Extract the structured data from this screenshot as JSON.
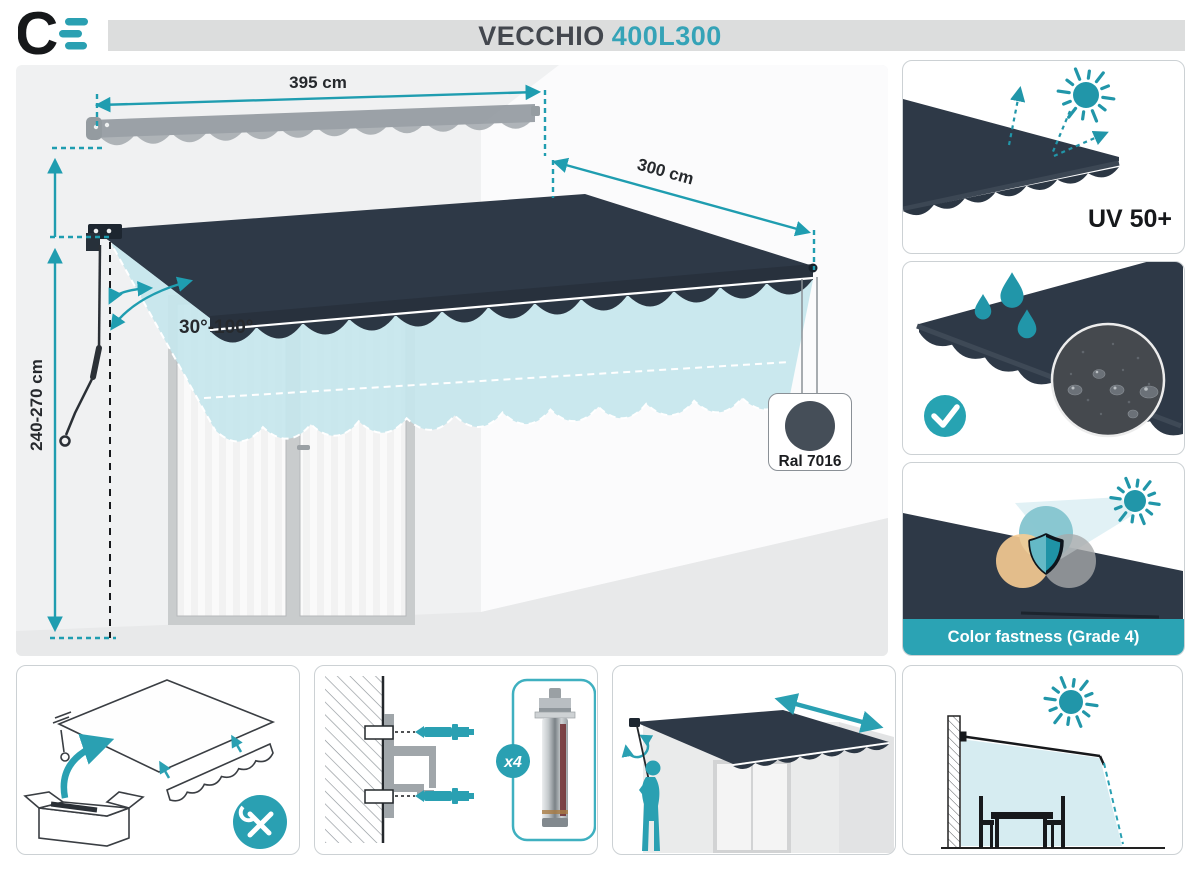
{
  "header": {
    "logo_letter": "C",
    "product_name": "VECCHIO",
    "product_model": "400L300"
  },
  "diagram": {
    "width_label": "395 cm",
    "projection_label": "300 cm",
    "height_label": "240-270 cm",
    "angle_label": "30°-100°",
    "fabric_color_label": "Ral 7016"
  },
  "features": {
    "uv_protection": {
      "label": "UV 50+"
    },
    "color_fastness": {
      "label": "Color fastness (Grade 4)"
    }
  },
  "installation": {
    "anchor_quantity_label": "x4"
  },
  "colors": {
    "accent_teal": "#2aa0b2",
    "dimension_teal": "#1f9db0",
    "fabric_navy": "#2e3947",
    "ghost_teal": "#c5e6ed",
    "ral7016_swatch": "#454e58",
    "title_bar_gray": "#dcdddd"
  }
}
